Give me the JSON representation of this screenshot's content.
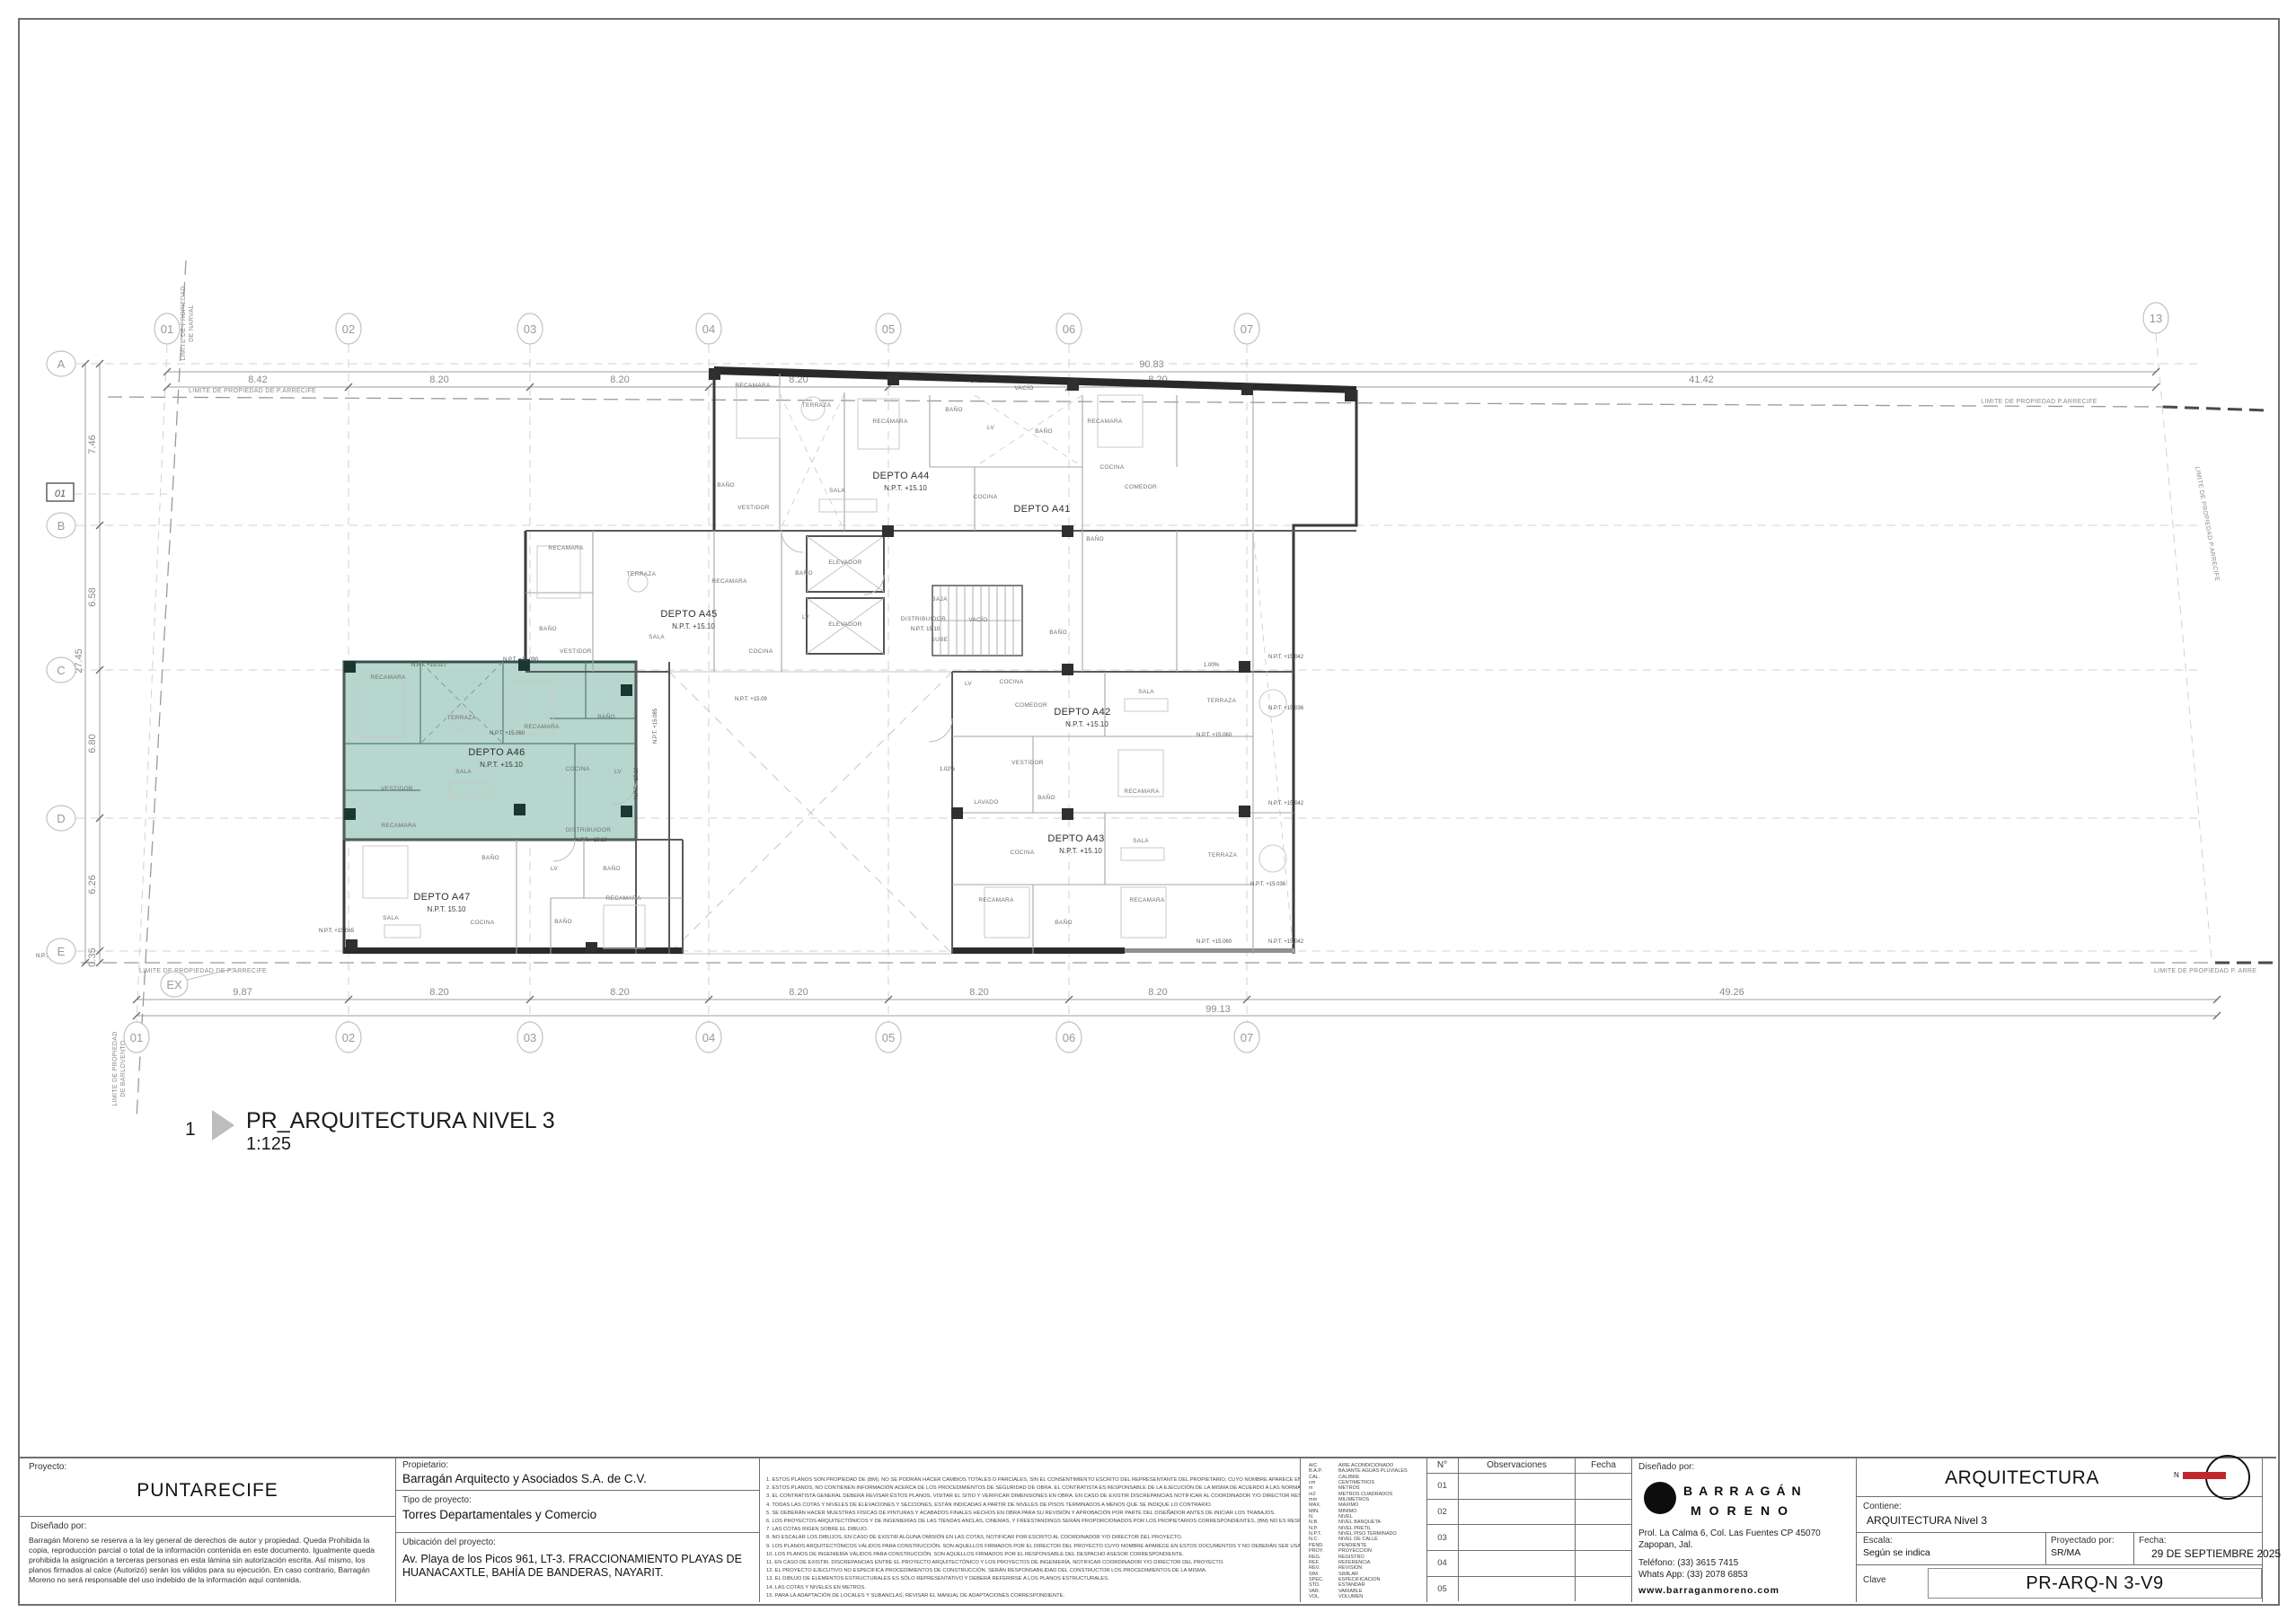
{
  "colors": {
    "highlight_fill": "#b7d6cd",
    "highlight_wall": "#33534c",
    "north_red": "#c1272d"
  },
  "drawing_label": {
    "number": "1",
    "title": "PR_ARQUITECTURA NIVEL 3",
    "scale": "1:125"
  },
  "grid": {
    "cols_top": [
      "01",
      "02",
      "03",
      "04",
      "05",
      "06",
      "07",
      "13"
    ],
    "cols_bottom": [
      "01",
      "02",
      "03",
      "04",
      "05",
      "06",
      "07"
    ],
    "rows": [
      "A",
      "B",
      "C",
      "D",
      "E"
    ],
    "dims_top": [
      "8.42",
      "8.20",
      "8.20",
      "8.20",
      "8.20",
      "8.20",
      "41.42"
    ],
    "dim_top_overall": "90.83",
    "dims_bottom": [
      "9.87",
      "8.20",
      "8.20",
      "8.20",
      "8.20",
      "8.20",
      "49.26"
    ],
    "dim_bottom_overall": "99.13",
    "dims_left": [
      "7.46",
      "6.58",
      "6.80",
      "6.26",
      "0.35"
    ],
    "dim_left_overall": "27.45",
    "level_tag": "01",
    "ex_tag": "EX"
  },
  "limits": {
    "top": "LIMITE DE PROPIEDAD DE P.ARRECIFE",
    "top_right": "LIMITE DE  PROPIEDAD P.ARRECIFE",
    "bottom": "LIMITE DE PROPIEDAD DE P.ARRECIFE",
    "bottom_right": "LIMITE DE  PROPIEDAD P. ARRE",
    "left_top": "LIMITE DE PROPIEDAD",
    "left_top2": "DE NARVAL",
    "left_bottom": "LIMITE DE PROPIEDAD",
    "left_bottom2": "DE BARLOVENTO",
    "right": "LIMITE DE PROPIEDAD P.ARRECIFE"
  },
  "plan": {
    "units": [
      {
        "name": "DEPTO A44",
        "npt": "N.P.T. +15.10"
      },
      {
        "name": "DEPTO A41",
        "npt": ""
      },
      {
        "name": "DEPTO A45",
        "npt": "N.P.T. +15.10"
      },
      {
        "name": "DEPTO A46",
        "npt": "N.P.T. +15.10"
      },
      {
        "name": "DEPTO A47",
        "npt": "N.P.T. 15.10"
      },
      {
        "name": "DEPTO A42",
        "npt": "N.P.T. +15.10"
      },
      {
        "name": "DEPTO A43",
        "npt": "N.P.T. +15.10"
      }
    ],
    "distribuidor": {
      "label": "DISTRIBUIDOR",
      "npt_core": "N.P.T. 15.10",
      "npt_left": "N.P.T. +15.10"
    },
    "rooms": [
      "RECAMARA",
      "TERRAZA",
      "RECAMARA",
      "BAÑO",
      "VACÍO",
      "LV",
      "BAÑO",
      "RECAMARA",
      "SALA",
      "COCINA",
      "COCINA",
      "COMEDOR",
      "BAÑO",
      "VESTIDOR",
      "RECAMARA",
      "TERRAZA",
      "RECAMARA",
      "BAÑO",
      "VESTIDOR",
      "SALA",
      "COCINA",
      "BAÑO",
      "ELEVADOR",
      "ELEVADOR",
      "LV",
      "BAJA",
      "SUBE",
      "VACÍO",
      "BAÑO",
      "RECAMARA",
      "TERRAZA",
      "RECAMARA",
      "BAÑO",
      "SALA",
      "VESTIDOR",
      "COCINA",
      "LV",
      "RECAMARA",
      "BAÑO",
      "LV",
      "BAÑO",
      "SALA",
      "COCINA",
      "BAÑO",
      "RECAMARA",
      "LV",
      "COCINA",
      "COMEDOR",
      "SALA",
      "TERRAZA",
      "VESTIDOR",
      "RECAMARA",
      "LAVADO",
      "BAÑO",
      "COCINA",
      "SALA",
      "TERRAZA",
      "RECAMARA",
      "BAÑO",
      "RECAMARA",
      "BAÑO",
      "BAÑO"
    ],
    "npt_markers": [
      "N.P.T. +15.027",
      "N.P.T. +15.090",
      "N.P.T. +15.060",
      "N.P.T. +15.09",
      "N.P.T. +15.042",
      "N.P.T. +15.036",
      "N.P.T. +15.060",
      "N.P.T. +15.042",
      "N.P.T. +15.036",
      "N.P.T. +15.060",
      "N.P.T. +15.042",
      "N.P.T. +15.085",
      "N.P.T. +15.10",
      "N.P.T. +15.065",
      "N.P.T. +15.06"
    ],
    "slopes": [
      "1.00%",
      "1.02%"
    ]
  },
  "notes": [
    "1.  ESTOS PLANOS SON PROPIEDAD DE (BM). NO SE PODRÁN HACER CAMBIOS TOTALES O PARCIALES, SIN EL CONSENTIMIENTO ESCRITO DEL REPRESENTANTE DEL PROPIETARIO, CUYO NOMBRE APARECE EN ESTOS DOCUMENTOS.",
    "2.  ESTOS PLANOS, NO CONTIENEN INFORMACIÓN ACERCA DE LOS PROCEDIMIENTOS DE SEGURIDAD DE OBRA. EL CONTRATISTA ES RESPONSABLE DE LA EJECUCIÓN DE LA MISMA DE ACUERDO A LAS NORMAS, REGLAMENTOS, LEYES Y PROCEDIMIENTOS APLICABLES VIGENTES.",
    "3.  EL CONTRATISTA GENERAL DEBERÁ REVISAR ÉSTOS PLANOS, VISITAR EL SITIO Y VERIFICAR DIMENSIONES EN OBRA. EN CASO DE EXISTIR DISCREPANCIAS NOTIFICAR AL COORDINADOR Y/O DIRECTOR RESPONSABLE DEL PROYECTO ANTES DE INICIAR LOS TRABAJOS.",
    "4.  TODAS LAS COTAS Y NIVELES DE ELEVACIONES Y SECCIONES, ESTÁN INDICADAS A PARTIR DE NIVELES DE PISOS TERMINADOS A MENOS QUE SE INDIQUE LO CONTRARIO.",
    "5.  SE DEBERÁN HACER MUESTRAS FÍSICAS DE PINTURAS Y ACABADOS FINALES HECHOS EN OBRA PARA SU REVISIÓN Y APROBACIÓN POR PARTE DEL DISEÑADOR ANTES DE INICIAR LOS TRABAJOS.",
    "6.  LOS PROYECTOS ARQUITECTÓNICOS Y DE INGENIERÍAS DE LAS TIENDAS ANCLAS, CINEMAS, Y FREESTANDINGS SERÁN PROPORCIONADOS POR LOS PROPIETARIOS CORRESPONDIENTES, (BM) NO ES RESPONSABLE POR EL CONTENIDO DE DICHA INFORMACIÓN.",
    "7.  LAS  COTAS RIGEN SOBRE EL DIBUJO.",
    "8.  NO ESCALAR LOS DIBUJOS, EN CASO DE EXISTIR ALGUNA OMISIÓN EN LAS COTAS, NOTIFICAR POR ESCRITO AL COORDINADOR Y/O DIRECTOR DEL PROYECTO.",
    "9.  LOS PLANOS ARQUITECTÓNICOS VÁLIDOS PARA CONSTRUCCIÓN, SON AQUELLOS FIRMADOS POR EL DIRECTOR DEL PROYECTO CUYO NOMBRE APARECE EN ESTOS DOCUMENTOS Y NO DEBERÁN SER USADOS PARA ÓRDENES DE TRABAJOS EJECUTADOS DERIVADOS DE CUALQUIER OTRO DIBUJO.",
    "10.  LOS PLANOS DE INGENIERÍA VÁLIDOS PARA CONSTRUCCIÓN, SON AQUELLOS FIRMADOS POR EL RESPONSABLE DEL DESPACHO ASESOR CORRESPONDIENTE.",
    "11.  EN CASO DE EXISTIR, DISCREPANCIAS ENTRE EL PROYECTO ARQUITECTÓNICO Y LOS PROYECTOS DE INGENIERÍA, NOTIFICAR COORDINADOR Y/O DIRECTOR DEL PROYECTO.",
    "12.  EL PROYECTO EJECUTIVO NO ESPECIFICA PROCEDIMIENTOS DE CONSTRUCCIÓN, SERÁN RESPONSABILIDAD DEL CONSTRUCTOR LOS PROCEDIMIENTOS DE LA MISMA.",
    "13.  EL DIBUJO DE ELEMENTOS ESTRUCTURALES ES SÓLO REPRESENTATIVO Y DEBERÁ REFERIRSE A LOS PLANOS ESTRUCTURALES.",
    "14.  LAS COTAS Y NIVELES EN METROS.",
    "15.  PARA LA ADAPTACIÓN DE LOCALES Y SUBANCLAS, REVISAR EL MANUAL DE ADAPTACIONES CORRESPONDIENTE."
  ],
  "abbreviations": [
    {
      "a": "A/C",
      "m": "AIRE ACONDICIONADO"
    },
    {
      "a": "B.A.P.",
      "m": "BAJANTE AGUAS PLUVIALES"
    },
    {
      "a": "CAL.",
      "m": "CALIBRE"
    },
    {
      "a": "cm",
      "m": "CENTIMETROS"
    },
    {
      "a": "m",
      "m": "METROS"
    },
    {
      "a": "m2",
      "m": "METROS CUADRADOS"
    },
    {
      "a": "mm",
      "m": "MILIMETROS"
    },
    {
      "a": "MAX.",
      "m": "MAXIMO"
    },
    {
      "a": "MIN.",
      "m": "MINIMO"
    },
    {
      "a": "N.",
      "m": "NIVEL"
    },
    {
      "a": "N.B.",
      "m": "NIVEL BANQUETA"
    },
    {
      "a": "N.P.",
      "m": "NIVEL PRETIL"
    },
    {
      "a": "N.P.T.",
      "m": "NIVEL PISO TERMINADO"
    },
    {
      "a": "N.C.",
      "m": "NIVEL DE CALLE"
    },
    {
      "a": "PEND.",
      "m": "PENDIENTE"
    },
    {
      "a": "PROY.",
      "m": "PROYECCION"
    },
    {
      "a": "REG.",
      "m": "REGISTRO"
    },
    {
      "a": "REF.",
      "m": "REFERENCIA"
    },
    {
      "a": "REV.",
      "m": "REVISION"
    },
    {
      "a": "SIM.",
      "m": "SIMILAR"
    },
    {
      "a": "SPEC.",
      "m": "ESPECIFICACION"
    },
    {
      "a": "STD.",
      "m": "ESTANDAR"
    },
    {
      "a": "VAR.",
      "m": "VARIABLE"
    },
    {
      "a": "VOL.",
      "m": "VOLUMEN"
    }
  ],
  "titleblock": {
    "proyecto_label": "Proyecto:",
    "proyecto": "PUNTARECIFE",
    "disenado_label": "Diseñado por:",
    "legal": "Barragán Moreno se reserva a la ley general de derechos de autor y propiedad. Queda Prohibida la copia, reproducción parcial o total de la información contenida en este documento. Igualmente queda prohibida la asignación a terceras personas en esta lámina sin autorización escrita. Así mismo, los planos firmados al calce (Autorizó) serán los válidos para su ejecución. En caso contrario, Barragán Moreno no será responsable del uso indebido de la información aquí contenida.",
    "propietario_label": "Propietario:",
    "propietario": "Barragán Arquitecto y Asociados S.A. de C.V.",
    "tipo_label": "Tipo de proyecto:",
    "tipo": "Torres Departamentales y Comercio",
    "ubicacion_label": "Ubicación del proyecto:",
    "ubicacion": "Av. Playa de los Picos 961, LT-3. FRACCIONAMIENTO PLAYAS DE HUANACAXTLE, BAHÍA DE BANDERAS, NAYARIT.",
    "observaciones": {
      "col_no": "N°",
      "col_obs": "Observaciones",
      "col_fecha": "Fecha",
      "rows": [
        "01",
        "02",
        "03",
        "04",
        "05"
      ]
    },
    "designer": {
      "label": "Diseñado por:",
      "logo1": "BARRAGÁN",
      "logo2": "MORENO",
      "address1": "Prol. La Calma 6, Col. Las Fuentes CP 45070",
      "address2": "Zapopan, Jal.",
      "phone": "Teléfono: (33) 3615 7415",
      "whatsapp": "Whats App: (33) 2078 6853",
      "web": "www.barraganmoreno.com"
    },
    "right": {
      "discipline": "ARQUITECTURA",
      "north_n": "N",
      "contiene_label": "Contiene:",
      "contiene": "ARQUITECTURA Nivel 3",
      "escala_label": "Escala:",
      "escala": "Según se indica",
      "proyectado_label": "Proyectado por:",
      "proyectado": "SR/MA",
      "fecha_label": "Fecha:",
      "fecha": "29 DE SEPTIEMBRE 2025",
      "clave_label": "Clave",
      "clave": "PR-ARQ-N 3-V9"
    }
  }
}
